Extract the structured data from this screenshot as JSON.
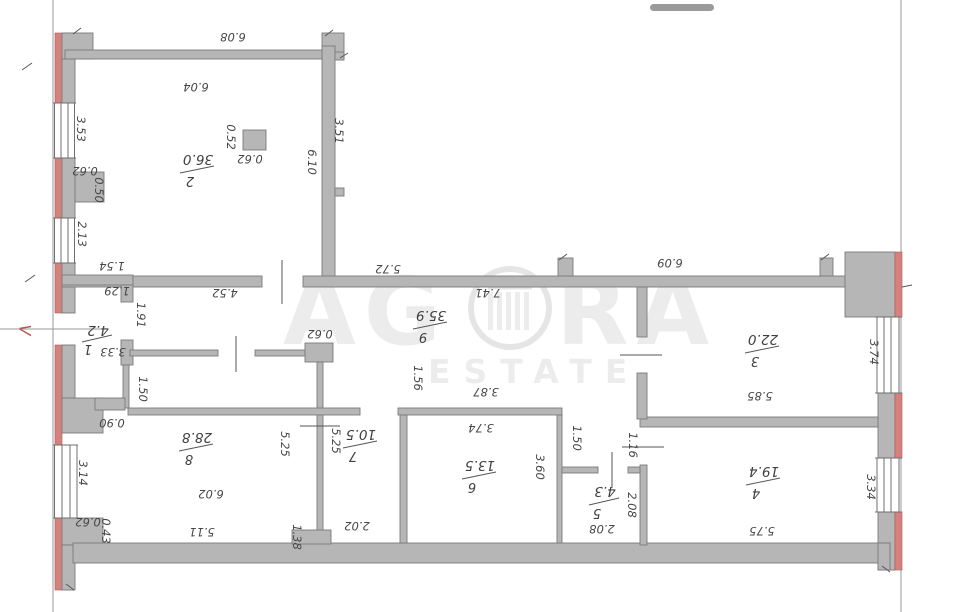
{
  "plan": {
    "watermark": {
      "brand_left": "AG",
      "brand_right": "RA",
      "tagline": "ESTATE"
    },
    "entry_mark": "V",
    "rooms": {
      "r1": {
        "number": "1",
        "area": "4.2"
      },
      "r2": {
        "number": "2",
        "area": "36.0"
      },
      "r3": {
        "number": "3",
        "area": "22.0"
      },
      "r4": {
        "number": "4",
        "area": "19.4"
      },
      "r5": {
        "number": "5",
        "area": "4.3"
      },
      "r6": {
        "number": "6",
        "area": "13.5"
      },
      "r7": {
        "number": "7",
        "area": "10.5"
      },
      "r8": {
        "number": "8",
        "area": "28.8"
      },
      "r9": {
        "number": "9",
        "area": "35.9"
      }
    },
    "dims": {
      "top_width": "6.08",
      "room2_width": "6.04",
      "room2_col_w": "0.52",
      "room2_col_h": "0.62",
      "room2_right_upper": "3.51",
      "room2_right": "6.10",
      "left_win_top": "3.53",
      "left_pier": "0.62",
      "left_pier_d": "0.50",
      "left_win_mid": "2.13",
      "hall_154": "1.54",
      "hall_129": "1.29",
      "hall_191": "1.91",
      "room1_333": "3.33",
      "hall_150": "1.50",
      "left_step": "0.90",
      "left_win_low": "3.14",
      "left_low_062": "0.62",
      "left_low_043": "0.43",
      "hall_572": "5.72",
      "hall_452": "4.52",
      "hall_741": "7.41",
      "hall_col": "0.62",
      "hall_156": "1.56",
      "room6_387": "3.87",
      "room6_374": "3.74",
      "room6_360": "3.60",
      "hall_niche": "1.50",
      "room8_525": "5.25",
      "room7_525": "5.25",
      "room8_138": "1.38",
      "room7_202": "2.02",
      "room8_w": "6.02",
      "room8_511": "5.11",
      "room3_top": "6.09",
      "right_win_top": "3.74",
      "room3_585": "5.85",
      "room4_116": "1.16",
      "room5_v": "2.08",
      "room5_h": "2.08",
      "right_win_low": "3.34",
      "room4_575": "5.75"
    }
  }
}
